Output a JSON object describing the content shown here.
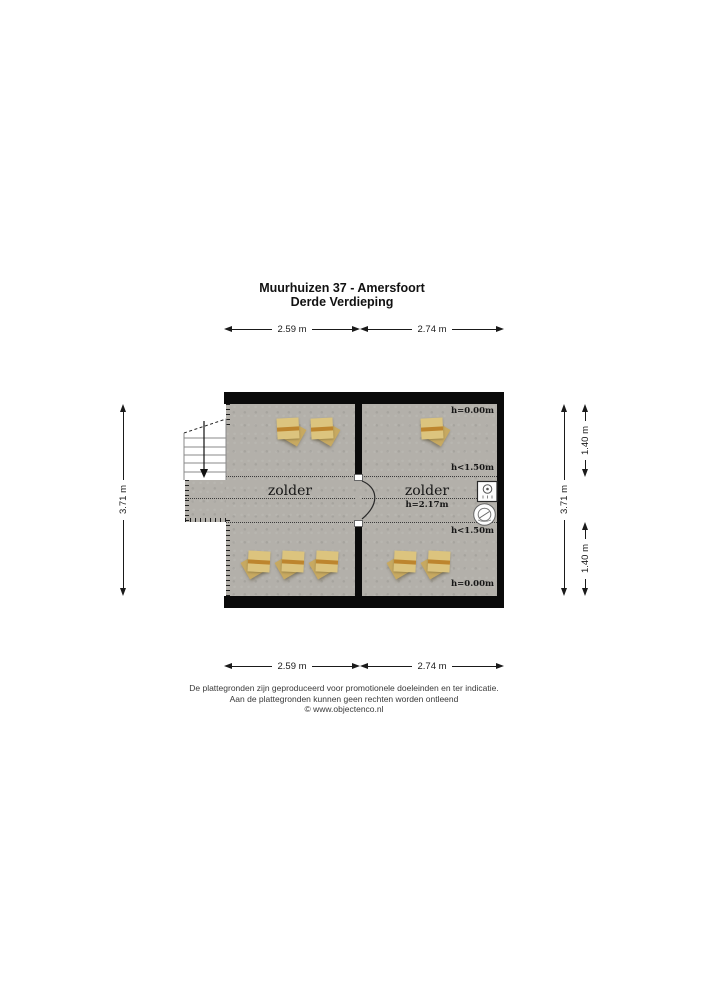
{
  "header": {
    "title_line1": "Muurhuizen 37 - Amersfoort",
    "title_line2": "Derde Verdieping"
  },
  "dimensions": {
    "top_left": "2.59 m",
    "top_right": "2.74 m",
    "bottom_left": "2.59 m",
    "bottom_right": "2.74 m",
    "left_side": "3.71 m",
    "right_side": "3.71 m",
    "right_outer_top": "1.40 m",
    "right_outer_bottom": "1.40 m"
  },
  "rooms": {
    "left": {
      "name": "zolder"
    },
    "right": {
      "name": "zolder",
      "ceiling_height": "h=2.17m"
    }
  },
  "height_labels": {
    "top": "h=0.00m",
    "upper": "h<1.50m",
    "lower": "h<1.50m",
    "bottom": "h=0.00m"
  },
  "footer": {
    "line1": "De plattegronden zijn geproduceerd voor promotionele doeleinden en ter indicatie.",
    "line2": "Aan de plattegronden kunnen geen rechten worden ontleend",
    "line3": "© www.objectenco.nl"
  },
  "colors": {
    "wall": "#0a0a0a",
    "floor": "#b3b0aa",
    "roof_window_frame": "#dcc47e",
    "roof_window_stripe": "#bd852e",
    "roof_window_flap": "#c7a961"
  }
}
